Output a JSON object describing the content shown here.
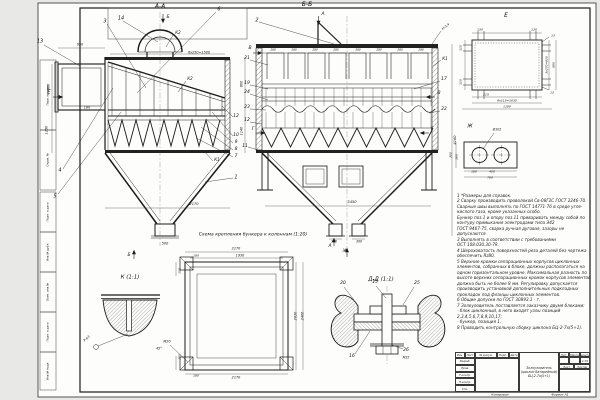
{
  "document": {
    "type": "engineering-drawing",
    "subject": "Золоуловитель (циклон батарейный) БЦ-2-7х(5+1)"
  },
  "notes": {
    "lines": [
      "1 *Размеры для справок.",
      "2 Сварку производить проволокой Св-08Г2С ГОСТ 2246-70.",
      "   Сварные швы выполнять по ГОСТ 14771-76 в среде угле-",
      "   кислого газа, кроме указанных особо.",
      "   Бункер поз.1 и опору поз.11 приваривать между собой по",
      "   контуру примыкания электродами типа Э42",
      "   ГОСТ 9467-75, сварка ручная дуговая, зазоры не",
      "   допускаются.",
      "3 Выполнять в соответствии с требованиями",
      "   ОСТ 108.030.30-79.",
      "4 Шероховатость поверхностей реза деталей без чертежа",
      "   обеспечить Rz80.",
      "5 Верхние кромки сепарационных корпусов циклонных",
      "   элементов, собранных в блоке, должны располагаться на",
      "   одном горизонтальном уровне. Максимальная разность по",
      "   высоте верхних сепарационных кромок корпусов элементов",
      "   должна быть не более 8 мм. Регулировку допускается",
      "   производить установкой дополнительных подкладных",
      "   прокладок под фланцы циклонных элементов.",
      "6 Общие допуски по ГОСТ 30893.1 - т.",
      "7 Золоуловитель поставляется заказчику двумя блоками:",
      "   - блок циклонный, в него входят узлы позиций",
      "   2,3,4,5,6,7,8,9,10,17;",
      "   - бункер, позиция 1.",
      "8 Проводить контрольную сборку циклона БЦ-2-7х(5+1)."
    ]
  },
  "title_block": {
    "name_line1": "Золоуловитель",
    "name_line2": "(циклон батарейный)",
    "name_line3": "БЦ-2-7х(5+1)",
    "cols": [
      "Изм.",
      "Лист",
      "№ докум.",
      "Подп.",
      "Дата"
    ],
    "rows": [
      "Разраб.",
      "Пров.",
      "Т.контр.",
      "Н.контр.",
      "Утв."
    ],
    "lit_label": "Лит.",
    "mass_label": "Масса",
    "scale_label": "Масштаб",
    "scale_value": "1:15",
    "sheet_label": "Лист",
    "sheets_label": "Листов"
  },
  "labels": [
    {
      "n": "view-label-aa",
      "t": "А-А",
      "x": 160,
      "y": 7,
      "s": 6
    },
    {
      "n": "section-arrow-b-top",
      "t": "Б",
      "x": 168,
      "y": 18,
      "s": 4.5
    },
    {
      "n": "callout-3",
      "t": "3",
      "x": 105,
      "y": 22,
      "s": 5
    },
    {
      "n": "callout-14",
      "t": "14",
      "x": 121,
      "y": 19,
      "s": 5
    },
    {
      "n": "callout-6",
      "t": "6",
      "x": 219,
      "y": 10,
      "s": 5
    },
    {
      "n": "callout-13",
      "t": "13",
      "x": 40,
      "y": 42,
      "s": 5
    },
    {
      "n": "callout-4",
      "t": "4",
      "x": 60,
      "y": 171,
      "s": 5
    },
    {
      "n": "callout-5",
      "t": "5",
      "x": 55,
      "y": 197,
      "s": 5
    },
    {
      "n": "callout-12r",
      "t": "12",
      "x": 236,
      "y": 117,
      "s": 4.5
    },
    {
      "n": "callout-10",
      "t": "10",
      "x": 236,
      "y": 136,
      "s": 4.5
    },
    {
      "n": "callout-9",
      "t": "9",
      "x": 236,
      "y": 143,
      "s": 4.5
    },
    {
      "n": "callout-8",
      "t": "8",
      "x": 236,
      "y": 150,
      "s": 4.5
    },
    {
      "n": "callout-7",
      "t": "7",
      "x": 236,
      "y": 157,
      "s": 4.5
    },
    {
      "n": "callout-1",
      "t": "1",
      "x": 236,
      "y": 178,
      "s": 5
    },
    {
      "n": "weld-k2-dome",
      "t": "К2",
      "x": 178,
      "y": 33,
      "s": 4
    },
    {
      "n": "weld-k2-slope",
      "t": "К2",
      "x": 190,
      "y": 79,
      "s": 4
    },
    {
      "n": "weld-k1-aa",
      "t": "К1",
      "x": 217,
      "y": 160,
      "s": 4
    },
    {
      "n": "dim-6x250",
      "t": "6х250=1500",
      "x": 199,
      "y": 53,
      "s": 3.4
    },
    {
      "n": "dim-950",
      "t": "950",
      "x": 80,
      "y": 45,
      "s": 3.4
    },
    {
      "n": "dim-860",
      "t": "860",
      "x": 49,
      "y": 87,
      "s": 3.4,
      "r": -90
    },
    {
      "n": "dim-1150",
      "t": "1150",
      "x": 47,
      "y": 130,
      "s": 3.4,
      "r": -90
    },
    {
      "n": "dim-180-aa",
      "t": "180",
      "x": 87,
      "y": 108,
      "s": 3.4
    },
    {
      "n": "dim-2170-aa",
      "t": "2170",
      "x": 194,
      "y": 205,
      "s": 3.6
    },
    {
      "n": "dim-500",
      "t": "500",
      "x": 165,
      "y": 244,
      "s": 3.4
    },
    {
      "n": "section-arrow-b-bottom",
      "t": "Б",
      "x": 129,
      "y": 256,
      "s": 4.5
    },
    {
      "n": "view-arrow-e",
      "t": "Е",
      "x": 49,
      "y": 93,
      "s": 5
    },
    {
      "n": "dim-800",
      "t": "800",
      "x": 242,
      "y": 84,
      "s": 3.4,
      "r": -90
    },
    {
      "n": "dim-1140",
      "t": "1140",
      "x": 242,
      "y": 131,
      "s": 3.4,
      "r": -90
    },
    {
      "n": "view-label-bb",
      "t": "Б-Б",
      "x": 307,
      "y": 5,
      "s": 6
    },
    {
      "n": "section-arrow-a-top",
      "t": "А",
      "x": 323,
      "y": 15,
      "s": 4.5
    },
    {
      "n": "callout-2",
      "t": "2",
      "x": 257,
      "y": 21,
      "s": 5
    },
    {
      "n": "callout-21",
      "t": "21",
      "x": 247,
      "y": 59,
      "s": 4.5
    },
    {
      "n": "callout-19",
      "t": "19",
      "x": 247,
      "y": 84,
      "s": 4.5
    },
    {
      "n": "callout-24",
      "t": "24",
      "x": 247,
      "y": 93,
      "s": 4.5
    },
    {
      "n": "callout-23",
      "t": "23",
      "x": 247,
      "y": 108,
      "s": 4.5
    },
    {
      "n": "callout-12",
      "t": "12",
      "x": 247,
      "y": 121,
      "s": 4.5
    },
    {
      "n": "callout-11",
      "t": "11",
      "x": 245,
      "y": 147,
      "s": 4.5
    },
    {
      "n": "callout-17",
      "t": "17",
      "x": 444,
      "y": 80,
      "s": 4.5
    },
    {
      "n": "callout-22",
      "t": "22",
      "x": 444,
      "y": 110,
      "s": 4.5
    },
    {
      "n": "weld-k1-bb",
      "t": "К1",
      "x": 445,
      "y": 59,
      "s": 4
    },
    {
      "n": "weld-n34",
      "t": "Н-3,4",
      "x": 446,
      "y": 27,
      "s": 3.2,
      "r": -38
    },
    {
      "n": "section-arrow-v-left",
      "t": "В",
      "x": 250,
      "y": 49,
      "s": 4.5
    },
    {
      "n": "section-arrow-v-right",
      "t": "В",
      "x": 439,
      "y": 94,
      "s": 4.5
    },
    {
      "n": "section-arrow-g-left",
      "t": "Г",
      "x": 253,
      "y": 130,
      "s": 4.5
    },
    {
      "n": "section-arrow-g-right",
      "t": "Г",
      "x": 432,
      "y": 130,
      "s": 4.5
    },
    {
      "n": "dim-280-1",
      "t": "280",
      "x": 273,
      "y": 50,
      "s": 2.8
    },
    {
      "n": "dim-280-2",
      "t": "280",
      "x": 294,
      "y": 50,
      "s": 2.8
    },
    {
      "n": "dim-280-3",
      "t": "280",
      "x": 315,
      "y": 50,
      "s": 2.8
    },
    {
      "n": "dim-280-4",
      "t": "280",
      "x": 336,
      "y": 50,
      "s": 2.8
    },
    {
      "n": "dim-280-5",
      "t": "280",
      "x": 358,
      "y": 50,
      "s": 2.8
    },
    {
      "n": "dim-280-6",
      "t": "280",
      "x": 379,
      "y": 50,
      "s": 2.8
    },
    {
      "n": "dim-280-7",
      "t": "280",
      "x": 400,
      "y": 50,
      "s": 2.8
    },
    {
      "n": "dim-280-8",
      "t": "280",
      "x": 421,
      "y": 50,
      "s": 2.8
    },
    {
      "n": "dim-4160",
      "t": "4160",
      "x": 456,
      "y": 140,
      "s": 3.6,
      "r": -90
    },
    {
      "n": "dim-3450",
      "t": "3450",
      "x": 352,
      "y": 203,
      "s": 3.6
    },
    {
      "n": "dim-300-left",
      "t": "300",
      "x": 334,
      "y": 242,
      "s": 3.2
    },
    {
      "n": "dim-300-right",
      "t": "300",
      "x": 359,
      "y": 242,
      "s": 3.2
    },
    {
      "n": "section-arrow-a-bottom",
      "t": "А",
      "x": 330,
      "y": 247,
      "s": 4.5
    },
    {
      "n": "view-arrow-zh",
      "t": "Ж",
      "x": 345,
      "y": 252,
      "s": 4.5
    },
    {
      "n": "view-label-e",
      "t": "Е",
      "x": 506,
      "y": 16,
      "s": 6
    },
    {
      "n": "dim-130-l",
      "t": "130",
      "x": 480,
      "y": 30,
      "s": 3
    },
    {
      "n": "dim-130-r",
      "t": "130",
      "x": 534,
      "y": 30,
      "s": 3
    },
    {
      "n": "dim-13-t",
      "t": "13",
      "x": 553,
      "y": 36,
      "s": 3
    },
    {
      "n": "dim-13-b",
      "t": "13",
      "x": 552,
      "y": 93,
      "s": 3
    },
    {
      "n": "dim-110-t",
      "t": "110",
      "x": 461,
      "y": 48,
      "s": 3,
      "r": -90
    },
    {
      "n": "dim-110-b",
      "t": "110",
      "x": 461,
      "y": 82,
      "s": 3,
      "r": -90
    },
    {
      "n": "dim-215",
      "t": "215",
      "x": 486,
      "y": 95,
      "s": 3
    },
    {
      "n": "dim-9x115",
      "t": "9х115=1035",
      "x": 507,
      "y": 101,
      "s": 3
    },
    {
      "n": "dim-1190",
      "t": "1190",
      "x": 507,
      "y": 107,
      "s": 3
    },
    {
      "n": "dim-3x270",
      "t": "3х270=810",
      "x": 547,
      "y": 65,
      "s": 3,
      "r": -90
    },
    {
      "n": "dim-880",
      "t": "880",
      "x": 554,
      "y": 65,
      "s": 3,
      "r": -90
    },
    {
      "n": "view-label-zh",
      "t": "Ж",
      "x": 470,
      "y": 127,
      "s": 5
    },
    {
      "n": "dim-d102",
      "t": "Ø102",
      "x": 497,
      "y": 130,
      "s": 3.2
    },
    {
      "n": "dim-300-zh",
      "t": "300",
      "x": 451,
      "y": 155,
      "s": 3,
      "r": -90
    },
    {
      "n": "dim-160-zh",
      "t": "160",
      "x": 457,
      "y": 157,
      "s": 3,
      "r": -90
    },
    {
      "n": "dim-180-zh",
      "t": "180",
      "x": 474,
      "y": 172,
      "s": 3
    },
    {
      "n": "dim-400-zh",
      "t": "400",
      "x": 492,
      "y": 172,
      "s": 3
    },
    {
      "n": "dim-760-zh",
      "t": "760",
      "x": 490,
      "y": 178,
      "s": 3
    },
    {
      "n": "view-label-k",
      "t": "К (1:1)",
      "x": 130,
      "y": 278,
      "s": 5.5
    },
    {
      "n": "weld-k-flag",
      "t": "Р-Ь3",
      "x": 87,
      "y": 339,
      "s": 3.2,
      "r": -40
    },
    {
      "n": "scheme-caption",
      "t": "Схема крепления бункера к колоннам (1:20)",
      "x": 253,
      "y": 236,
      "s": 4.6
    },
    {
      "n": "dim-2170-top",
      "t": "2170",
      "x": 236,
      "y": 249,
      "s": 3.4
    },
    {
      "n": "dim-1930",
      "t": "1930",
      "x": 240,
      "y": 256,
      "s": 3.4
    },
    {
      "n": "dim-180-sch-t",
      "t": "180",
      "x": 196,
      "y": 256,
      "s": 3
    },
    {
      "n": "dim-2170-bot",
      "t": "2170",
      "x": 236,
      "y": 378,
      "s": 3.4
    },
    {
      "n": "dim-2400",
      "t": "2400",
      "x": 303,
      "y": 316,
      "s": 3.4,
      "r": -90
    },
    {
      "n": "dim-2020",
      "t": "2020",
      "x": 296,
      "y": 316,
      "s": 3.4,
      "r": -90
    },
    {
      "n": "dim-100-t",
      "t": "100",
      "x": 180,
      "y": 271,
      "s": 3,
      "r": -90
    },
    {
      "n": "dim-100-b",
      "t": "100",
      "x": 180,
      "y": 357,
      "s": 3,
      "r": -90
    },
    {
      "n": "note-m20",
      "t": "М20",
      "x": 167,
      "y": 342,
      "s": 3.4
    },
    {
      "n": "note-45deg",
      "t": "45°",
      "x": 159,
      "y": 349,
      "s": 3.4
    },
    {
      "n": "dim-180-sch-b",
      "t": "180",
      "x": 196,
      "y": 376,
      "s": 3
    },
    {
      "n": "view-label-dd",
      "t": "Д-Д (1:1)",
      "x": 381,
      "y": 280,
      "s": 5.5
    },
    {
      "n": "callout-20",
      "t": "20",
      "x": 343,
      "y": 284,
      "s": 4.5
    },
    {
      "n": "callout-15",
      "t": "15",
      "x": 375,
      "y": 283,
      "s": 4.5
    },
    {
      "n": "callout-25",
      "t": "25",
      "x": 417,
      "y": 284,
      "s": 4.5
    },
    {
      "n": "callout-16",
      "t": "16",
      "x": 352,
      "y": 357,
      "s": 4.5
    },
    {
      "n": "callout-26",
      "t": "26",
      "x": 406,
      "y": 351,
      "s": 4.5
    },
    {
      "n": "note-m22",
      "t": "М22",
      "x": 406,
      "y": 358,
      "s": 3.2
    },
    {
      "n": "stamp-inv-podl",
      "t": "Инв.№ подл.",
      "x": 48,
      "y": 371,
      "s": 2.8,
      "r": -90
    },
    {
      "n": "stamp-podp-data-1",
      "t": "Подп. и дата",
      "x": 48,
      "y": 332,
      "s": 2.8,
      "r": -90
    },
    {
      "n": "stamp-vzam-inv",
      "t": "Взам. инв.№",
      "x": 48,
      "y": 292,
      "s": 2.8,
      "r": -90
    },
    {
      "n": "stamp-inv-dubl",
      "t": "Инв.№ дубл.",
      "x": 48,
      "y": 252,
      "s": 2.8,
      "r": -90
    },
    {
      "n": "stamp-podp-data-2",
      "t": "Подп. и дата",
      "x": 48,
      "y": 212,
      "s": 2.8,
      "r": -90
    },
    {
      "n": "stamp-sprav",
      "t": "Справ. №",
      "x": 48,
      "y": 160,
      "s": 2.8,
      "r": -90
    },
    {
      "n": "stamp-perv-primen",
      "t": "Перв. примен.",
      "x": 48,
      "y": 95,
      "s": 2.8,
      "r": -90
    },
    {
      "n": "label-kopiroval",
      "t": "Копировал",
      "x": 500,
      "y": 395,
      "s": 3
    },
    {
      "n": "label-format",
      "t": "Формат А1",
      "x": 560,
      "y": 395,
      "s": 3
    }
  ]
}
